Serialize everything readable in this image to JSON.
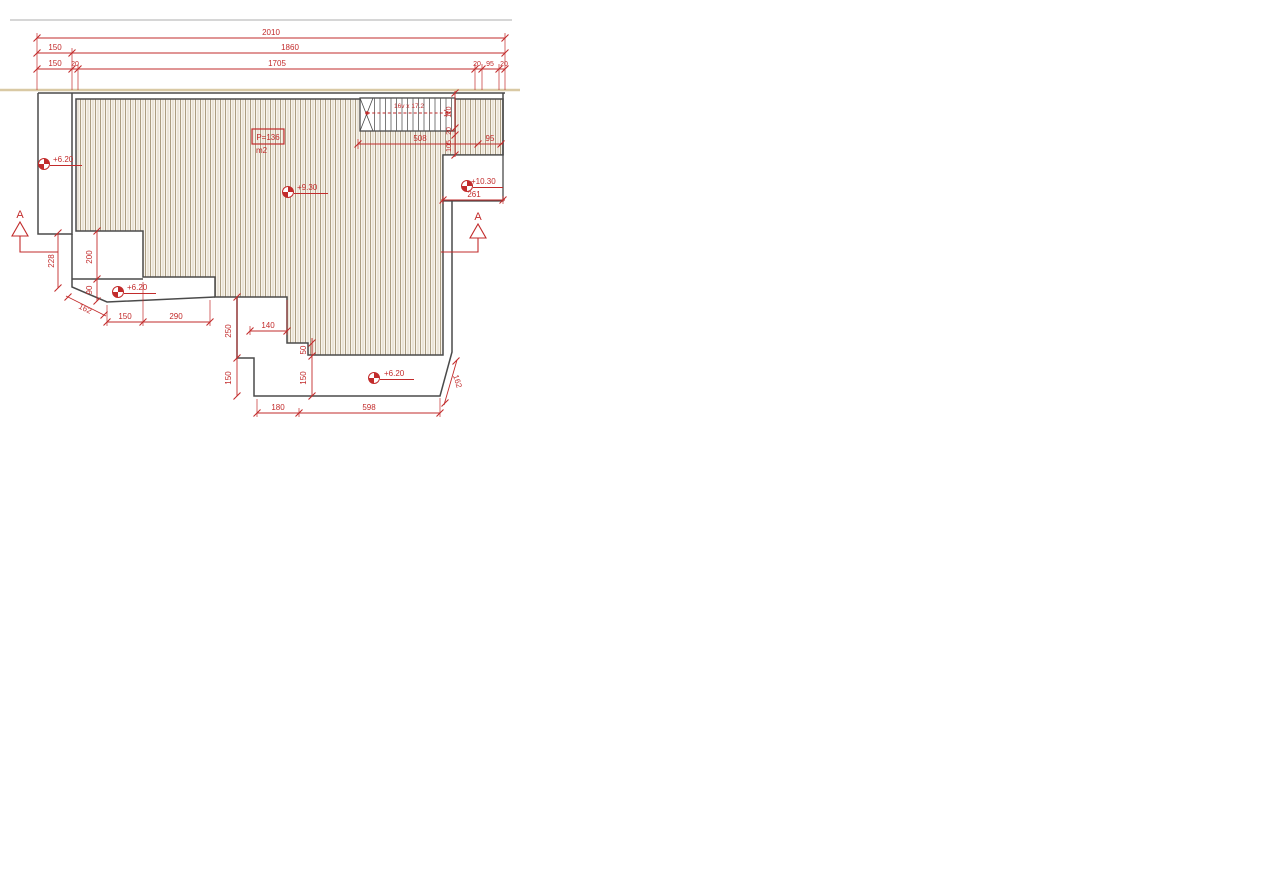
{
  "drawing": {
    "type": "architectural terrace plan",
    "colors": {
      "red": "#c22b2b",
      "outline": "#4a4a4a",
      "hatch_line": "#b3a68c",
      "hatch_bg": "#f8f4ec",
      "tan_line": "#d9c9a4",
      "gray_line": "#c9c9c9"
    },
    "dims": {
      "top_row1": [
        "2010"
      ],
      "top_row2": [
        "150",
        "1860"
      ],
      "top_row3": [
        "150",
        "20",
        "1705",
        "20",
        "95",
        "20"
      ],
      "stair_width": "508",
      "stair_side": "95",
      "stair_vertical": [
        "110",
        "20",
        "105"
      ],
      "landing_width": "261",
      "left_vertical": [
        "228",
        "200",
        "90"
      ],
      "left_diagonal": "162",
      "left_bottom": [
        "150",
        "290"
      ],
      "notch_width": "140",
      "mid_vertical": [
        "250",
        "150"
      ],
      "step_vertical": [
        "50",
        "150"
      ],
      "bottom": [
        "180",
        "598"
      ],
      "right_diagonal": "162"
    },
    "levels": {
      "left": "+6.20",
      "mid_left": "+6.20",
      "center": "+9.30",
      "bottom": "+6.20",
      "landing": "+10.30"
    },
    "stair": {
      "label": "16v x 17.2"
    },
    "area": {
      "value": "P=136",
      "unit": "m2"
    },
    "section_markers": {
      "left": "A",
      "right": "A"
    }
  }
}
